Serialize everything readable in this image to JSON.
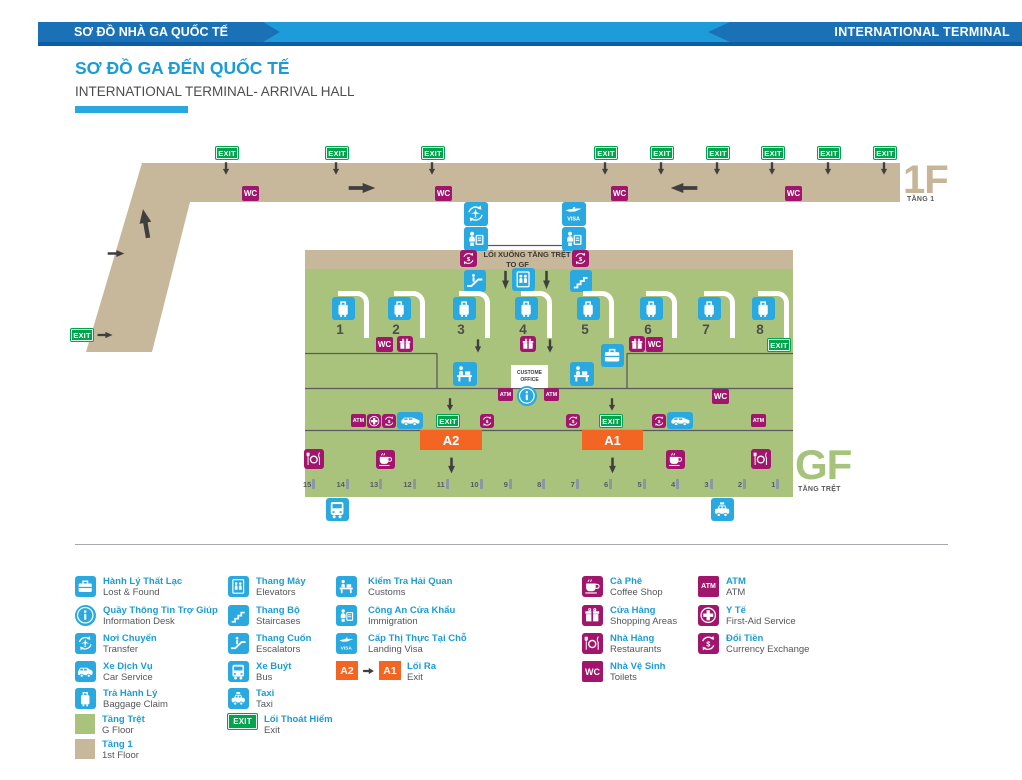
{
  "header": {
    "left_label": "SƠ ĐỒ NHÀ GA QUỐC TẾ",
    "right_label": "INTERNATIONAL TERMINAL"
  },
  "title": {
    "vn": "SƠ ĐỒ GA ĐẾN QUỐC TẾ",
    "en": "INTERNATIONAL TERMINAL- ARRIVAL HALL"
  },
  "colors": {
    "accent_blue": "#1e9cd9",
    "dark_blue": "#1a71b6",
    "underline_blue": "#0d5da6",
    "icon_blue": "#2aa9e0",
    "icon_magenta": "#a1156c",
    "exit_green": "#00a44f",
    "floor_green": "#a9c27c",
    "floor_tan": "#c8b89b",
    "exit_orange": "#f26522"
  },
  "map": {
    "floor_1f": {
      "big": "1F",
      "sub": "TẦNG 1"
    },
    "floor_gf": {
      "big": "GF",
      "sub": "TẦNG TRỆT"
    },
    "down_sign": {
      "line1": "LỐI XUỐNG TẦNG TRỆT",
      "line2": "TO GF"
    },
    "labels": {
      "exit": "EXIT",
      "wc": "WC",
      "atm": "ATM",
      "visa": "VISA",
      "a1": "A1",
      "a2": "A2",
      "office": "CUSTOME OFFICE"
    },
    "carousel_numbers": [
      1,
      2,
      3,
      4,
      5,
      6,
      7,
      8
    ],
    "gate_numbers": [
      15,
      14,
      13,
      12,
      11,
      10,
      9,
      8,
      7,
      6,
      5,
      4,
      3,
      2,
      1
    ],
    "markers": [
      {
        "t": "exit",
        "x": 216,
        "y": 147
      },
      {
        "t": "exit",
        "x": 326,
        "y": 147
      },
      {
        "t": "exit",
        "x": 422,
        "y": 147
      },
      {
        "t": "exit",
        "x": 595,
        "y": 147
      },
      {
        "t": "exit",
        "x": 651,
        "y": 147
      },
      {
        "t": "exit",
        "x": 707,
        "y": 147
      },
      {
        "t": "exit",
        "x": 762,
        "y": 147
      },
      {
        "t": "exit",
        "x": 818,
        "y": 147
      },
      {
        "t": "exit",
        "x": 874,
        "y": 147
      },
      {
        "t": "arr-d",
        "x": 221,
        "y": 161,
        "w": 10,
        "h": 15
      },
      {
        "t": "arr-d",
        "x": 331,
        "y": 161,
        "w": 10,
        "h": 15
      },
      {
        "t": "arr-d",
        "x": 427,
        "y": 161,
        "w": 10,
        "h": 15
      },
      {
        "t": "arr-d",
        "x": 600,
        "y": 161,
        "w": 10,
        "h": 15
      },
      {
        "t": "arr-d",
        "x": 656,
        "y": 161,
        "w": 10,
        "h": 15
      },
      {
        "t": "arr-d",
        "x": 712,
        "y": 161,
        "w": 10,
        "h": 15
      },
      {
        "t": "arr-d",
        "x": 767,
        "y": 161,
        "w": 10,
        "h": 15
      },
      {
        "t": "arr-d",
        "x": 823,
        "y": 161,
        "w": 10,
        "h": 15
      },
      {
        "t": "arr-d",
        "x": 879,
        "y": 161,
        "w": 10,
        "h": 15
      },
      {
        "t": "wc",
        "x": 242,
        "y": 186
      },
      {
        "t": "wc",
        "x": 435,
        "y": 186
      },
      {
        "t": "wc",
        "x": 611,
        "y": 186
      },
      {
        "t": "wc",
        "x": 785,
        "y": 186
      },
      {
        "t": "arr-r",
        "x": 346,
        "y": 180,
        "w": 32,
        "h": 16
      },
      {
        "t": "arr-l",
        "x": 668,
        "y": 180,
        "w": 32,
        "h": 16
      },
      {
        "t": "arr-u",
        "x": 136,
        "y": 206,
        "w": 19,
        "h": 35,
        "r": -10
      },
      {
        "t": "arr-r",
        "x": 106,
        "y": 248,
        "w": 20,
        "h": 11
      },
      {
        "t": "exit",
        "x": 71,
        "y": 329
      },
      {
        "t": "arr-r",
        "x": 96,
        "y": 330,
        "w": 18,
        "h": 10
      },
      {
        "t": "transfer",
        "x": 464,
        "y": 202,
        "w": 24
      },
      {
        "t": "immigration",
        "x": 464,
        "y": 227,
        "w": 24
      },
      {
        "t": "visa",
        "x": 562,
        "y": 202,
        "w": 24
      },
      {
        "t": "immigration",
        "x": 562,
        "y": 227,
        "w": 24
      },
      {
        "t": "currency",
        "x": 460,
        "y": 250,
        "w": 17
      },
      {
        "t": "currency",
        "x": 572,
        "y": 250,
        "w": 17
      },
      {
        "t": "escalator",
        "x": 464,
        "y": 270,
        "w": 22
      },
      {
        "t": "arr-d",
        "x": 500,
        "y": 269,
        "w": 11,
        "h": 22
      },
      {
        "t": "elevator",
        "x": 512,
        "y": 268,
        "w": 23
      },
      {
        "t": "arr-d",
        "x": 541,
        "y": 269,
        "w": 11,
        "h": 22
      },
      {
        "t": "stairs",
        "x": 570,
        "y": 270,
        "w": 22
      },
      {
        "t": "carousel",
        "x": 332,
        "y": 297,
        "n": 0
      },
      {
        "t": "carousel",
        "x": 388,
        "y": 297,
        "n": 1
      },
      {
        "t": "carousel",
        "x": 453,
        "y": 297,
        "n": 2
      },
      {
        "t": "carousel",
        "x": 515,
        "y": 297,
        "n": 3
      },
      {
        "t": "carousel",
        "x": 577,
        "y": 297,
        "n": 4
      },
      {
        "t": "carousel",
        "x": 640,
        "y": 297,
        "n": 5
      },
      {
        "t": "carousel",
        "x": 698,
        "y": 297,
        "n": 6
      },
      {
        "t": "carousel",
        "x": 752,
        "y": 297,
        "n": 7
      },
      {
        "t": "wc",
        "x": 376,
        "y": 337
      },
      {
        "t": "gift",
        "x": 397,
        "y": 336,
        "w": 16
      },
      {
        "t": "arr-d",
        "x": 473,
        "y": 338,
        "w": 10,
        "h": 16
      },
      {
        "t": "gift",
        "x": 520,
        "y": 336,
        "w": 16
      },
      {
        "t": "arr-d",
        "x": 545,
        "y": 338,
        "w": 10,
        "h": 16
      },
      {
        "t": "lost-found",
        "x": 601,
        "y": 344,
        "w": 23
      },
      {
        "t": "gift",
        "x": 629,
        "y": 336,
        "w": 16
      },
      {
        "t": "wc",
        "x": 646,
        "y": 337
      },
      {
        "t": "exit",
        "x": 768,
        "y": 339
      },
      {
        "t": "customs",
        "x": 453,
        "y": 362,
        "w": 24
      },
      {
        "t": "office",
        "x": 511,
        "y": 365,
        "w": 37,
        "h": 23
      },
      {
        "t": "customs",
        "x": 570,
        "y": 362,
        "w": 24
      },
      {
        "t": "atm",
        "x": 498,
        "y": 388
      },
      {
        "t": "info",
        "x": 517,
        "y": 386,
        "w": 20
      },
      {
        "t": "atm",
        "x": 544,
        "y": 388
      },
      {
        "t": "wc",
        "x": 712,
        "y": 389
      },
      {
        "t": "arr-d",
        "x": 445,
        "y": 397,
        "w": 10,
        "h": 15
      },
      {
        "t": "arr-d",
        "x": 607,
        "y": 397,
        "w": 10,
        "h": 15
      },
      {
        "t": "atm",
        "x": 351,
        "y": 414
      },
      {
        "t": "firstaid",
        "x": 367,
        "y": 414,
        "w": 14
      },
      {
        "t": "currency",
        "x": 382,
        "y": 414,
        "w": 14
      },
      {
        "t": "car",
        "x": 397,
        "y": 412,
        "w": 26,
        "h": 17
      },
      {
        "t": "exit",
        "x": 437,
        "y": 415
      },
      {
        "t": "currency",
        "x": 480,
        "y": 414,
        "w": 14
      },
      {
        "t": "currency",
        "x": 566,
        "y": 414,
        "w": 14
      },
      {
        "t": "exit",
        "x": 600,
        "y": 415
      },
      {
        "t": "currency",
        "x": 652,
        "y": 414,
        "w": 14
      },
      {
        "t": "car",
        "x": 667,
        "y": 412,
        "w": 26,
        "h": 17
      },
      {
        "t": "atm",
        "x": 751,
        "y": 414
      },
      {
        "t": "a2",
        "x": 420,
        "y": 430,
        "w": 62,
        "h": 20
      },
      {
        "t": "a1",
        "x": 582,
        "y": 430,
        "w": 61,
        "h": 20
      },
      {
        "t": "restaurant",
        "x": 304,
        "y": 449,
        "w": 20
      },
      {
        "t": "coffee",
        "x": 376,
        "y": 450,
        "w": 19
      },
      {
        "t": "arr-d",
        "x": 446,
        "y": 456,
        "w": 11,
        "h": 19
      },
      {
        "t": "arr-d",
        "x": 607,
        "y": 456,
        "w": 11,
        "h": 19
      },
      {
        "t": "coffee",
        "x": 666,
        "y": 450,
        "w": 19
      },
      {
        "t": "restaurant",
        "x": 751,
        "y": 449,
        "w": 20
      },
      {
        "t": "bus",
        "x": 326,
        "y": 498,
        "w": 23
      },
      {
        "t": "taxi",
        "x": 711,
        "y": 498,
        "w": 23
      }
    ]
  },
  "legend": {
    "columns": [
      {
        "items": [
          {
            "icon": "lost-found",
            "vn": "Hành Lý Thất Lạc",
            "en": "Lost & Found"
          },
          {
            "icon": "info",
            "vn": "Quầy Thông Tin Trợ Giúp",
            "en": "Information Desk"
          },
          {
            "icon": "transfer",
            "vn": "Nơi Chuyển",
            "en": "Transfer"
          },
          {
            "icon": "car",
            "vn": "Xe Dịch Vụ",
            "en": "Car Service"
          },
          {
            "icon": "luggage",
            "vn": "Trả Hành Lý",
            "en": "Baggage Claim"
          },
          {
            "icon": "gfloor",
            "vn": "Tầng Trệt",
            "en": "G Floor"
          },
          {
            "icon": "f1floor",
            "vn": "Tầng 1",
            "en": "1st Floor"
          }
        ]
      },
      {
        "items": [
          {
            "icon": "elevator",
            "vn": "Thang Máy",
            "en": "Elevators"
          },
          {
            "icon": "stairs",
            "vn": "Thang Bộ",
            "en": "Staircases"
          },
          {
            "icon": "escalator",
            "vn": "Thang Cuốn",
            "en": "Escalators"
          },
          {
            "icon": "bus",
            "vn": "Xe Buýt",
            "en": "Bus"
          },
          {
            "icon": "taxi",
            "vn": "Taxi",
            "en": "Taxi"
          },
          {
            "icon": "exitbadge",
            "vn": "Lối Thoát Hiểm",
            "en": "Exit"
          }
        ]
      },
      {
        "items": [
          {
            "icon": "customs",
            "vn": "Kiểm Tra Hải Quan",
            "en": "Customs"
          },
          {
            "icon": "immigration",
            "vn": "Công An Cửa Khẩu",
            "en": "Immigration"
          },
          {
            "icon": "visa",
            "vn": "Cấp Thị Thực Tại Chỗ",
            "en": "Landing Visa"
          },
          {
            "icon": "a2a1",
            "vn": "Lối Ra",
            "en": "Exit"
          }
        ]
      },
      {
        "items": [
          {
            "icon": "coffee",
            "vn": "Cà Phê",
            "en": "Coffee Shop"
          },
          {
            "icon": "gift",
            "vn": "Cửa Hàng",
            "en": "Shopping Areas"
          },
          {
            "icon": "restaurant",
            "vn": "Nhà Hàng",
            "en": "Restaurants"
          },
          {
            "icon": "wcbadge",
            "vn": "Nhà Vệ Sinh",
            "en": "Toilets"
          }
        ]
      },
      {
        "items": [
          {
            "icon": "atmbadge",
            "vn": "ATM",
            "en": "ATM"
          },
          {
            "icon": "firstaid",
            "vn": "Y Tế",
            "en": "First-Aid Service"
          },
          {
            "icon": "currency",
            "vn": "Đổi Tiền",
            "en": "Currency Exchange"
          }
        ]
      }
    ]
  }
}
